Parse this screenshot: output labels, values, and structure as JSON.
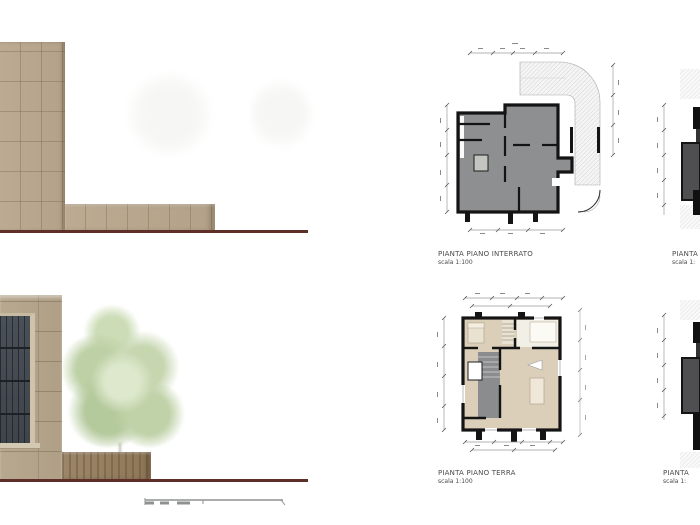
{
  "sheet": {
    "background": "#ffffff"
  },
  "labels": {
    "basement": {
      "title": "PIANTA PIANO INTERRATO",
      "scale": "scala 1:100"
    },
    "ground": {
      "title": "PIANTA PIANO TERRA",
      "scale": "scala 1:100"
    },
    "partial_top": {
      "title": "PIANTA",
      "scale": "scala 1:"
    },
    "partial_bottom": {
      "title": "PIANTA",
      "scale": "scala 1:"
    }
  },
  "colors": {
    "sheet_bg": "#ffffff",
    "masonry": "#bcab92",
    "stone": "#b7a88f",
    "window_glass": "#3f444b",
    "planter": "#9c8669",
    "ground_line": "#5e2f29",
    "plan_gray": "#8e8f91",
    "plan_beige": "#dbcfba",
    "plan_wall": "#141414",
    "stair_gray": "#8b8c8e"
  }
}
